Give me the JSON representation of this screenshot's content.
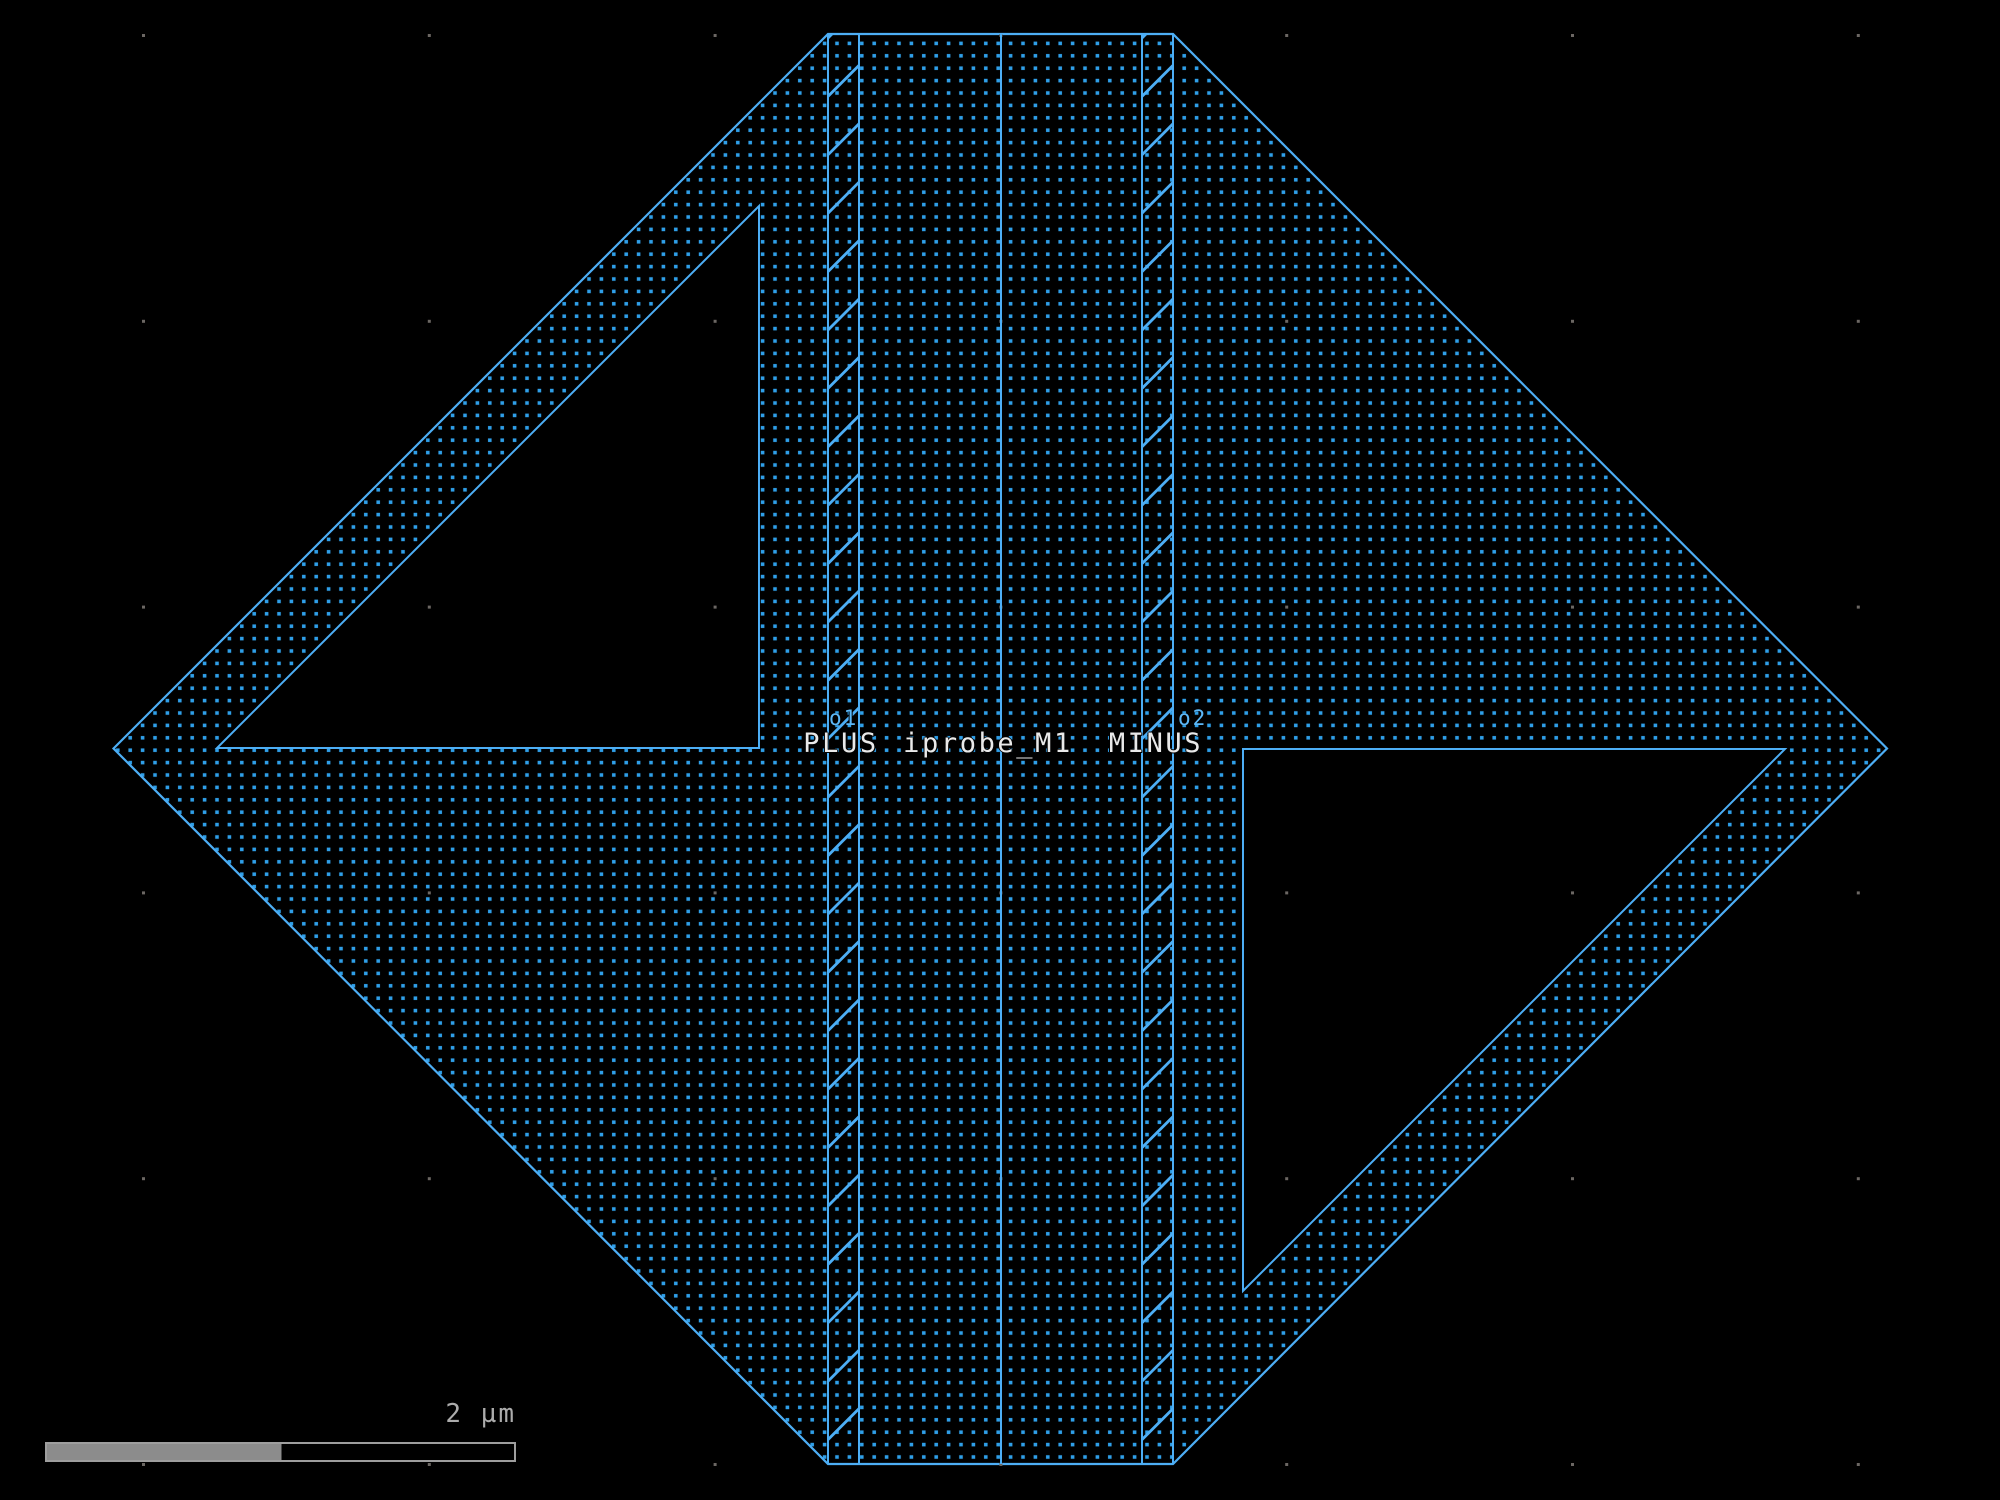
{
  "canvas": {
    "width": 2000,
    "height": 1500,
    "background": "#000000"
  },
  "labels": {
    "pin_plus": "PLUS",
    "net_name": "iprobe_M1",
    "pin_minus": "MINUS",
    "port1": "o1",
    "port2": "o2"
  },
  "scalebar": {
    "label": "2 µm",
    "filled_fraction": 0.5
  },
  "colors": {
    "background": "#000000",
    "layer_fill_dot": "#2F9FE8",
    "layer_outline": "#4DAEF5",
    "pin_label_text": "#5CB8F8",
    "main_label_text": "#E9E9E9",
    "grid_dot": "#6B6763",
    "scalebar_fill": "#8C8C8C",
    "scalebar_outline": "#9E9E9E",
    "scalebar_text": "#ACACAC"
  },
  "figure": {
    "hexagon": [
      [
        113.5,
        748.5
      ],
      [
        828,
        34
      ],
      [
        1173,
        34
      ],
      [
        1887,
        748.5
      ],
      [
        1173,
        1464
      ],
      [
        828,
        1464
      ]
    ],
    "cutouts": [
      [
        [
          217,
          748
        ],
        [
          759,
          748
        ],
        [
          759,
          206
        ]
      ],
      [
        [
          1243,
          749
        ],
        [
          1243,
          1291
        ],
        [
          1785,
          749
        ]
      ]
    ],
    "strips": [
      {
        "x1": 828,
        "x2": 859
      },
      {
        "x1": 1142,
        "x2": 1173
      }
    ],
    "y_top": 34,
    "y_bottom": 1464,
    "center_line_x": 1001,
    "hatch_period": 58.4,
    "hatch_anchor": 38,
    "stipple_pitch": 12.4,
    "stipple_dot": 3.6,
    "grid": {
      "x0": 143.5,
      "y0": 35.5,
      "pitch": 285.8,
      "nx": 7,
      "ny": 6,
      "dot": 3
    },
    "scalebar_geom": {
      "x": 46,
      "y": 1443,
      "width": 469,
      "height": 18
    }
  }
}
